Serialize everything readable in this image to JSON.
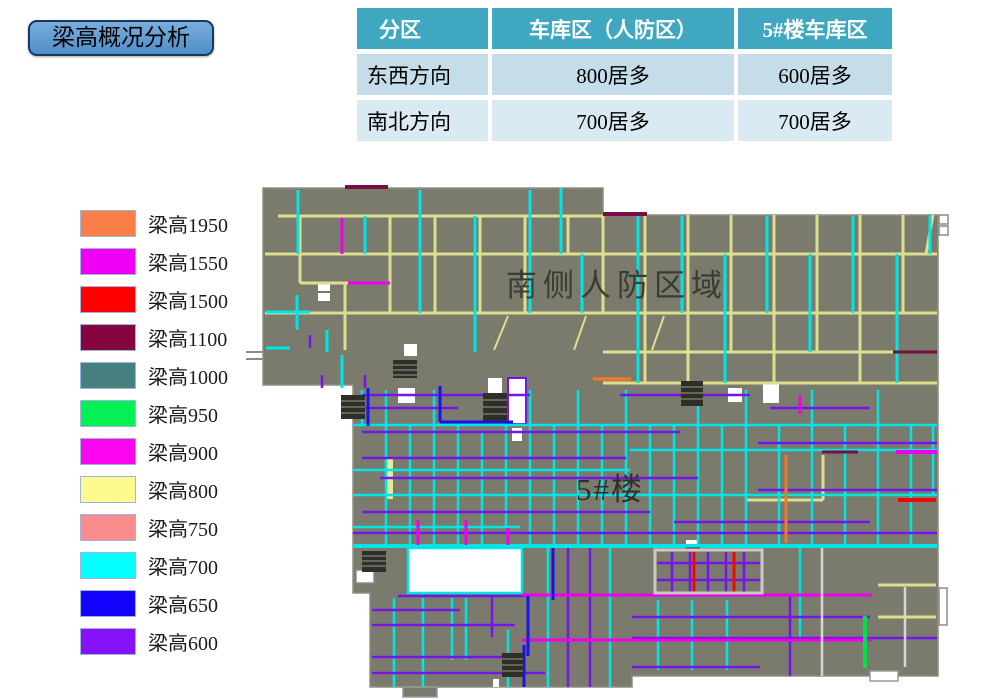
{
  "title": {
    "label": "梁高概况分析"
  },
  "table": {
    "headers": [
      "分区",
      "车库区（人防区）",
      "5#楼车库区"
    ],
    "rows": [
      {
        "cells": [
          "东西方向",
          "800居多",
          "600居多"
        ]
      },
      {
        "cells": [
          "南北方向",
          "700居多",
          "700居多"
        ]
      }
    ],
    "colors": {
      "header_bg": "#3FA7BF",
      "row_odd": "#C4DDE9",
      "row_even": "#DAEAF2"
    }
  },
  "legend": {
    "items": [
      {
        "label": "梁高1950",
        "color": "#F98048"
      },
      {
        "label": "梁高1550",
        "color": "#EE00F5"
      },
      {
        "label": "梁高1500",
        "color": "#FE0000"
      },
      {
        "label": "梁高1100",
        "color": "#85063F"
      },
      {
        "label": "梁高1000",
        "color": "#46807F"
      },
      {
        "label": "梁高950",
        "color": "#04F054"
      },
      {
        "label": "梁高900",
        "color": "#FB04EE"
      },
      {
        "label": "梁高800",
        "color": "#FDFB8E"
      },
      {
        "label": "梁高750",
        "color": "#F98D8D"
      },
      {
        "label": "梁高700",
        "color": "#04FDFD"
      },
      {
        "label": "梁高650",
        "color": "#1502FC"
      },
      {
        "label": "梁高600",
        "color": "#8512F8"
      }
    ]
  },
  "plan": {
    "labels": {
      "civil_defense_zone": "南侧人防区域",
      "building5": "5#楼"
    },
    "colors": {
      "background": "#7B7B6D",
      "beam800_yellow": "#DEDE8E",
      "beam700_cyan": "#00E6E6",
      "beam600_purple": "#7516E8",
      "beam650_blue": "#1A10F0",
      "beam900_magenta": "#EE00EE",
      "beam1100_maroon": "#7A0D45",
      "beam1500_red": "#EE0808",
      "beam1950_orange": "#F07828",
      "beam950_green": "#00E050"
    }
  }
}
